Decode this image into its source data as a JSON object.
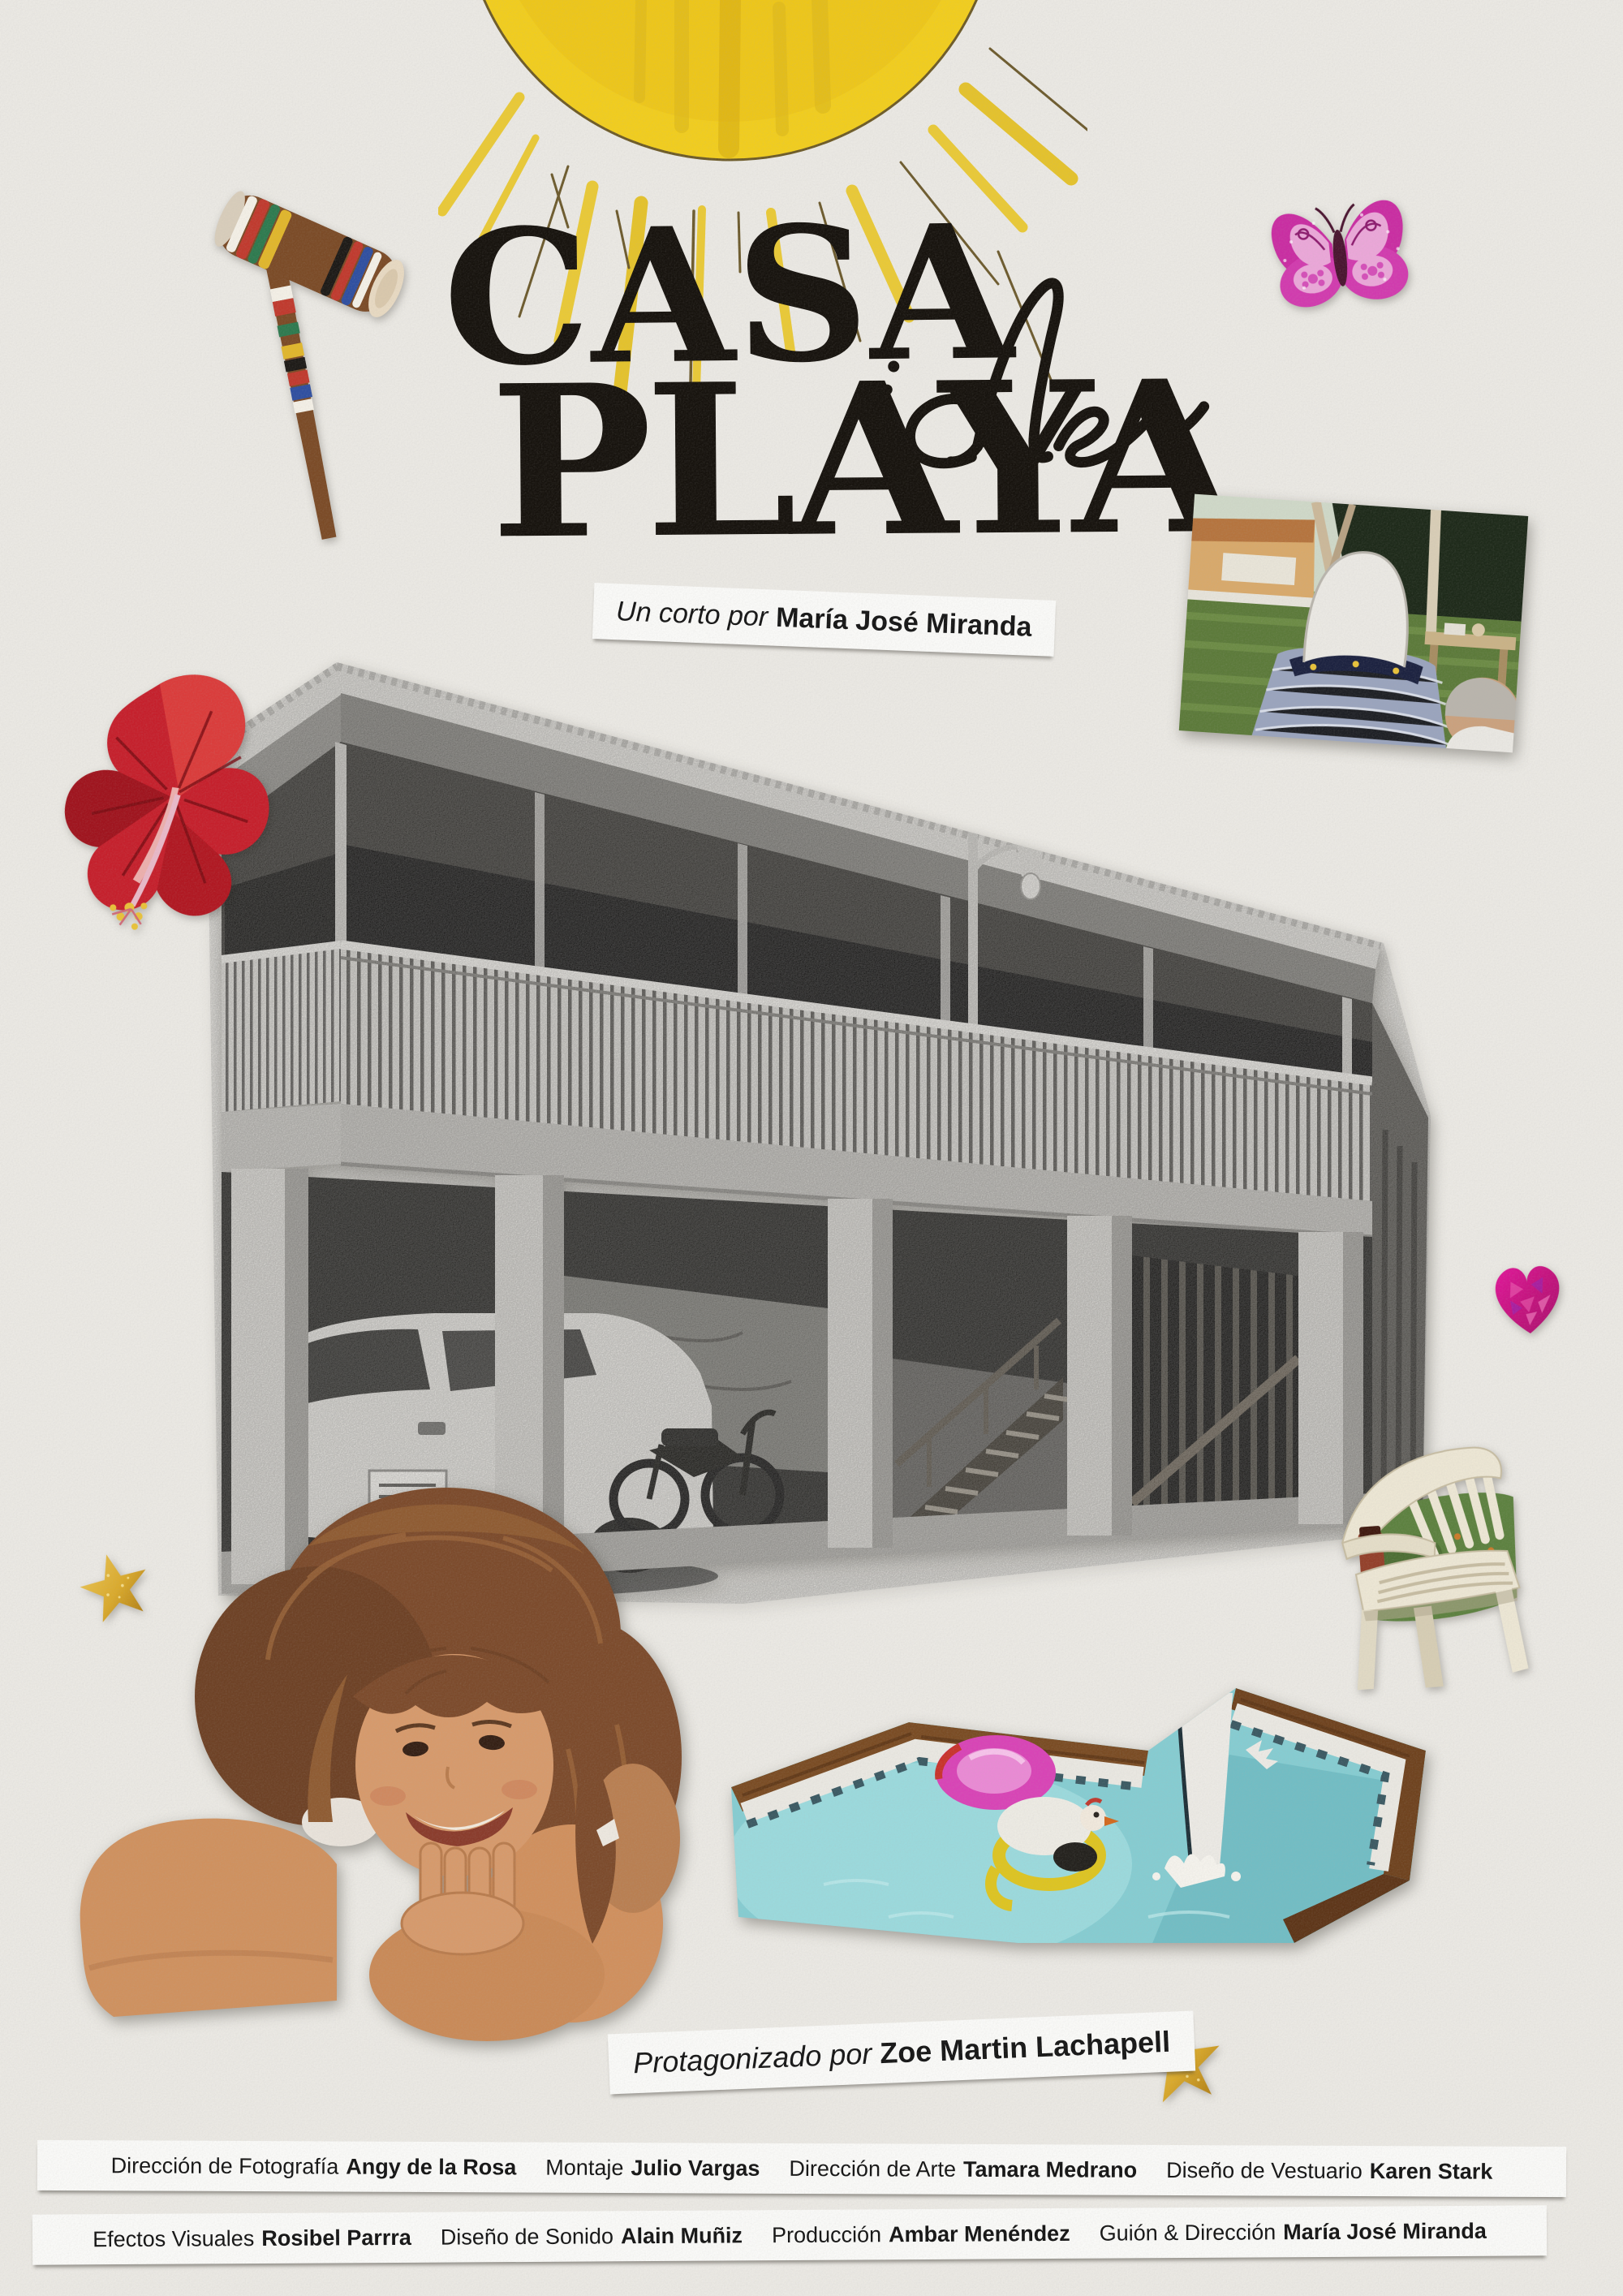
{
  "poster": {
    "background_color": "#eae8e3",
    "title": {
      "line1": "CASA",
      "script_word": "de",
      "line2": "PLAYA",
      "color": "#17130e"
    },
    "byline": {
      "prefix": "Un corto por",
      "name": "María José Miranda"
    },
    "starring": {
      "prefix": "Protagonizado por",
      "name": "Zoe Martin Lachapell"
    },
    "credits": {
      "row1": [
        {
          "role": "Dirección de Fotografía",
          "name": "Angy de la Rosa"
        },
        {
          "role": "Montaje",
          "name": "Julio Vargas"
        },
        {
          "role": "Dirección de Arte",
          "name": "Tamara Medrano"
        },
        {
          "role": "Diseño de Vestuario",
          "name": "Karen Stark"
        }
      ],
      "row2": [
        {
          "role": "Efectos Visuales",
          "name": "Rosibel Parrra"
        },
        {
          "role": "Diseño de Sonido",
          "name": "Alain Muñiz"
        },
        {
          "role": "Producción",
          "name": "Ambar Menéndez"
        },
        {
          "role": "Guión & Dirección",
          "name": "María José Miranda"
        }
      ]
    },
    "collage_elements": {
      "sun": {
        "label": "hand-drawn crayon sun",
        "color": "#f1cd1e"
      },
      "croquet_mallet": {
        "label": "striped wooden croquet mallet"
      },
      "butterfly_sticker": {
        "label": "pink glitter butterfly sticker",
        "color": "#c92da2"
      },
      "hibiscus_flower": {
        "label": "red hibiscus flower cutout",
        "color": "#c5202c"
      },
      "beach_house_photo": {
        "label": "black-and-white two-story beach house on pillars with car, motorcycle and stairs"
      },
      "party_photo": {
        "label": "backyard party snapshot with face cut out"
      },
      "heart_sticker": {
        "label": "pink holographic heart sticker",
        "color": "#d6177c"
      },
      "chair_photo": {
        "label": "white plastic chair cutout on grass"
      },
      "girl_photo": {
        "label": "smiling girl resting chin on hands cutout"
      },
      "pool_photo": {
        "label": "pool with floats and cut-out jumping swimmer"
      },
      "star_sticker_left": {
        "label": "gold glitter star",
        "color": "#d9a92c"
      },
      "star_sticker_right": {
        "label": "gold glitter star",
        "color": "#d9a92c"
      }
    }
  }
}
